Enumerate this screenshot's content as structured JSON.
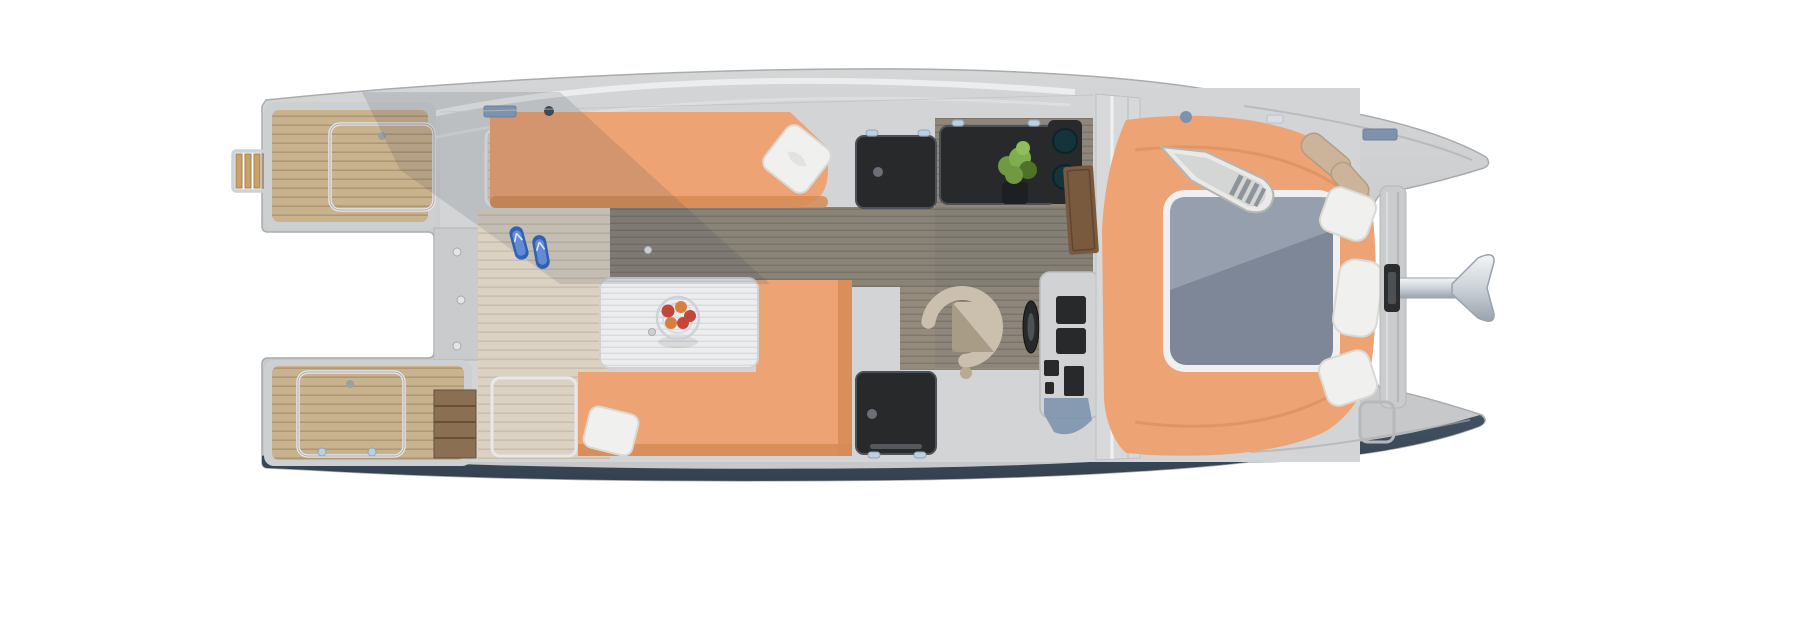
{
  "scene": {
    "description_objects": [
      "catamaran-deck-plan-top-view",
      "swim-ladder",
      "stern-swim-platform",
      "deck-hatch",
      "companionway-stairs",
      "flip-flops",
      "salon-sofa",
      "throw-pillow",
      "dinette-table",
      "fruit-bowl",
      "dinette-bench",
      "galley-dark-hatch",
      "galley-counter",
      "herb-plant",
      "double-sink",
      "faucet",
      "helm-chair",
      "steering-wheel",
      "helm-console",
      "cabin-door",
      "bow-sunpad",
      "bow-skylight-window",
      "model-dinghy",
      "bolster-cushion",
      "bow-pillow",
      "bowsprit",
      "anchor",
      "anchor-vent",
      "bow-walkway",
      "bow-deck-hatch"
    ],
    "palette": {
      "background": "#ffffff",
      "hull-mid": "#c6c8ca",
      "hull-light": "#d4d6d7",
      "hull-rim": "#a9acaf",
      "hull-highlight": "#eef0f1",
      "deck-base": "#d2d4d5",
      "navy": "#3c4c5e",
      "navy-deep": "#2c3a49",
      "teak": "#c9b28e",
      "teak-line": "#a8906c",
      "washed": "#dbd2c4",
      "washed-line": "#c3b8a4",
      "plank": "#948b7d",
      "plank-line": "#6f675b",
      "orange": "#eda374",
      "orange-deep": "#d68c57",
      "white-soft": "#f0f0ee",
      "pillow-line": "#d9d9d4",
      "slate": "#7e8797",
      "slate-sheen": "#99a3b2",
      "dark-glass": "#27292b",
      "chrome": "#ccd2d8",
      "chrome-deep": "#9aa2ac",
      "frame-chrome": "#e6e8ea",
      "latch": "#9aa0a5",
      "steel-blue": "#7d93ad",
      "beige": "#cbbfae",
      "beige-deep": "#a3957f",
      "green": "#6f9a42",
      "green-deep": "#4f7227",
      "apple": "#c4463a",
      "apple2": "#d87f3f",
      "door-wood": "#7a5a3e",
      "stairs-wood": "#8a6f52",
      "stairs-line": "#66503a",
      "flipflop": "#2f66c4",
      "flipflop-light": "#6b97e8",
      "shadow": "#39434f",
      "table": "#ebedee",
      "table-line": "#d8dadb"
    }
  }
}
